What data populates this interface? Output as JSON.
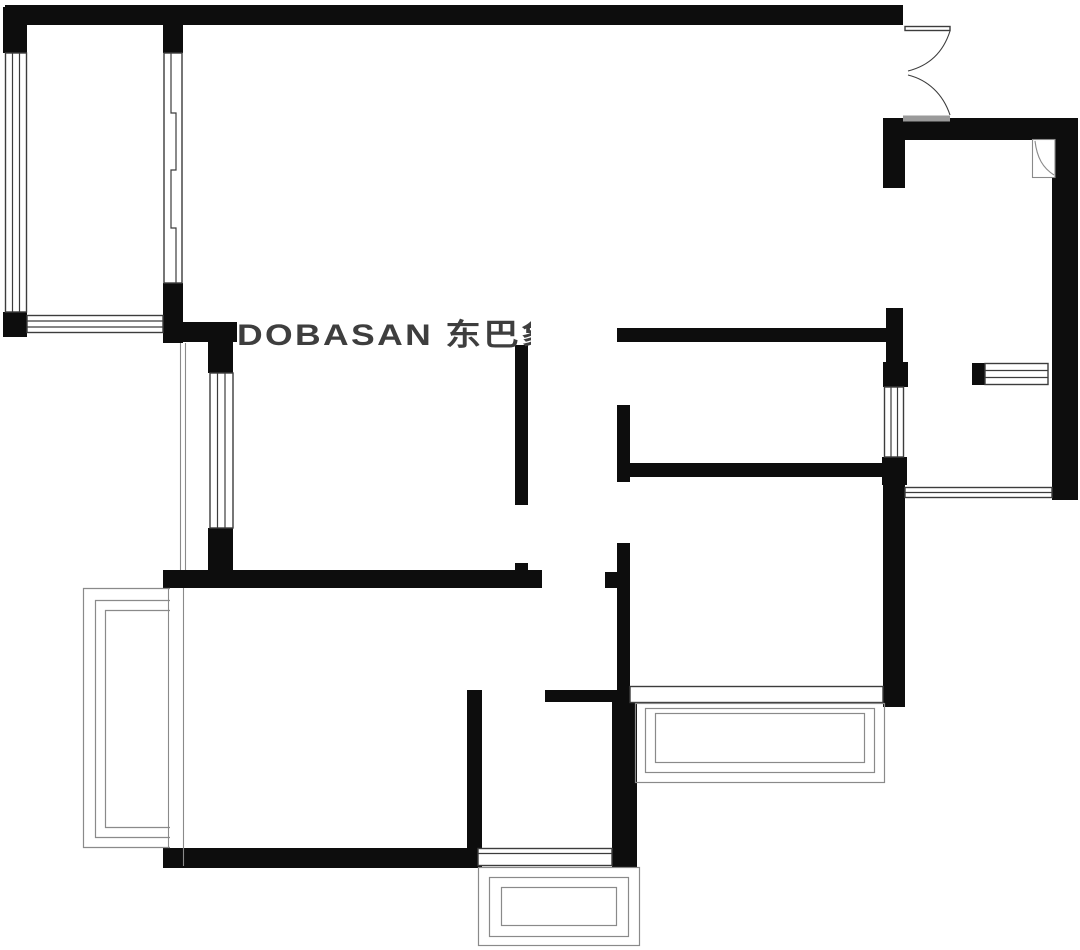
{
  "document": {
    "type": "residential floor plan drawing",
    "background_note": "black-and-white architectural plan, no room labels or dimensions visible"
  },
  "watermark": {
    "text": "DOBASAN 东巴象"
  },
  "colors": {
    "background": "#ffffff",
    "wall": "#0d0d0d",
    "line": "#3c3c3c",
    "line_light": "#8a8a8a",
    "watermark": "#3e3e3e",
    "door_sill": "#9a9a9a"
  },
  "symbols": {
    "window": "parallel-line window symbol",
    "bay_window": "nested-rectangle bay window symbol",
    "entry_door": "double-leaf swing door symbol",
    "flue": "white duct box with diagonal curve",
    "sliding_door": "offset parallel track symbol"
  }
}
